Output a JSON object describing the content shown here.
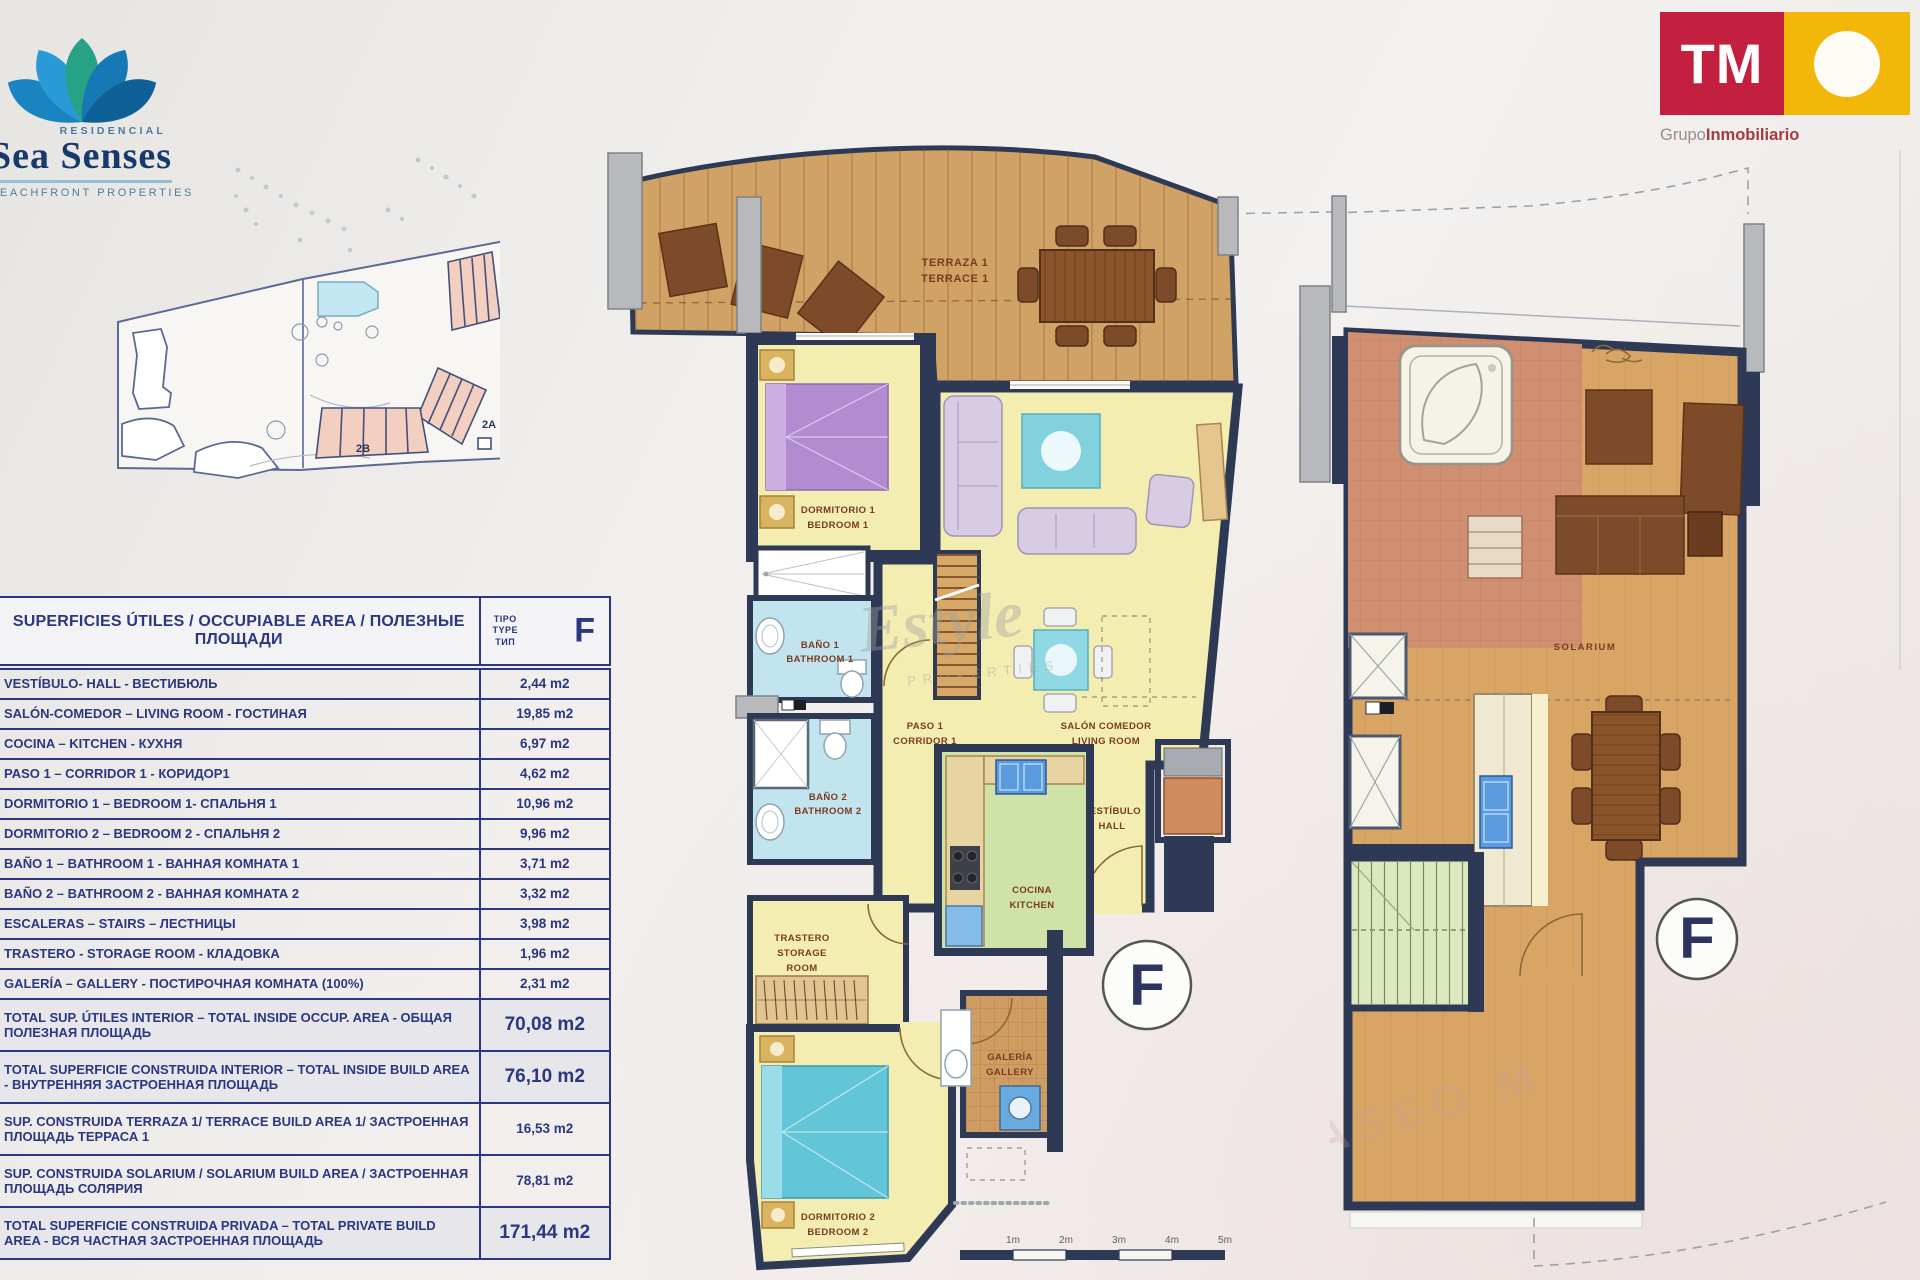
{
  "branding": {
    "residencial": "RESIDENCIAL",
    "name": "Sea Senses",
    "tagline": "BEACHFRONT PROPERTIES",
    "tm": "TM",
    "grupo": "Grupo",
    "inmobiliario": "Inmobiliario",
    "colors": {
      "crimson": "#c2203e",
      "yellow": "#f3b70a",
      "navy": "#17396b",
      "teal": "#27a287",
      "blue": "#1d7ab5"
    }
  },
  "site_plan": {
    "building_labels": [
      "1",
      "2A",
      "2B"
    ]
  },
  "table": {
    "title": "SUPERFICIES ÚTILES / OCCUPIABLE AREA / ПОЛЕЗНЫЕ ПЛОЩАДИ",
    "type_label": [
      "TIPO",
      "TYPE",
      "ТИП"
    ],
    "type_value": "F",
    "rows": [
      {
        "label": "VESTÍBULO- HALL - ВЕСТИБЮЛЬ",
        "value": "2,44 m2"
      },
      {
        "label": "SALÓN-COMEDOR – LIVING ROOM - ГОСТИНАЯ",
        "value": "19,85 m2"
      },
      {
        "label": "COCINA – KITCHEN - КУХНЯ",
        "value": "6,97 m2"
      },
      {
        "label": "PASO 1 – CORRIDOR 1 - КОРИДОР1",
        "value": "4,62 m2"
      },
      {
        "label": "DORMITORIO 1 – BEDROOM 1- СПАЛЬНЯ 1",
        "value": "10,96 m2"
      },
      {
        "label": "DORMITORIO 2 – BEDROOM 2 - СПАЛЬНЯ 2",
        "value": "9,96 m2"
      },
      {
        "label": "BAÑO 1 – BATHROOM 1 - ВАННАЯ КОМНАТА 1",
        "value": "3,71 m2"
      },
      {
        "label": "BAÑO 2 – BATHROOM 2 - ВАННАЯ КОМНАТА 2",
        "value": "3,32 m2"
      },
      {
        "label": "ESCALERAS – STAIRS – ЛЕСТНИЦЫ",
        "value": "3,98 m2"
      },
      {
        "label": "TRASTERO - STORAGE ROOM - КЛАДОВКА",
        "value": "1,96 m2"
      },
      {
        "label": "GALERÍA – GALLERY - ПОСТИРОЧНАЯ КОМНАТА (100%)",
        "value": "2,31 m2"
      },
      {
        "label": "TOTAL SUP. ÚTILES INTERIOR –  TOTAL INSIDE OCCUP. AREA - ОБЩАЯ ПОЛЕЗНАЯ ПЛОЩАДЬ",
        "value": "70,08 m2",
        "strong": true
      },
      {
        "label": "TOTAL SUPERFICIE CONSTRUIDA INTERIOR –  TOTAL INSIDE BUILD AREA - ВНУТРЕННЯЯ ЗАСТРОЕННАЯ ПЛОЩАДЬ",
        "value": "76,10 m2",
        "strong": true
      },
      {
        "label": "SUP. CONSTRUIDA TERRAZA 1/ TERRACE BUILD AREA 1/ ЗАСТРОЕННАЯ ПЛОЩАДЬ ТЕРРАСА 1",
        "value": "16,53 m2"
      },
      {
        "label": "SUP. CONSTRUIDA SOLARIUM / SOLARIUM BUILD AREA / ЗАСТРОЕННАЯ ПЛОЩАДЬ СОЛЯРИЯ",
        "value": "78,81 m2"
      },
      {
        "label": "TOTAL SUPERFICIE CONSTRUIDA PRIVADA – TOTAL PRIVATE BUILD AREA - ВСЯ ЧАСТНАЯ ЗАСТРОЕННАЯ ПЛОЩАДЬ",
        "value": "171,44 m2",
        "strong": true
      }
    ]
  },
  "plan_main": {
    "unit_letter": "F",
    "labels": {
      "terraza": [
        "TERRAZA 1",
        "TERRACE 1"
      ],
      "dormitorio1": [
        "DORMITORIO 1",
        "BEDROOM 1"
      ],
      "bano1": [
        "BAÑO 1",
        "BATHROOM 1"
      ],
      "bano2": [
        "BAÑO 2",
        "BATHROOM 2"
      ],
      "paso": [
        "PASO 1",
        "CORRIDOR 1"
      ],
      "salon": [
        "SALÓN COMEDOR",
        "LIVING ROOM"
      ],
      "vestibulo": [
        "VESTÍBULO",
        "HALL"
      ],
      "cocina": [
        "COCINA",
        "KITCHEN"
      ],
      "trastero": [
        "TRASTERO",
        "STORAGE",
        "ROOM"
      ],
      "galeria": [
        "GALERÍA",
        "GALLERY"
      ],
      "dormitorio2": [
        "DORMITORIO 2",
        "BEDROOM 2"
      ]
    }
  },
  "plan_solarium": {
    "label": "SOLARIUM",
    "unit_letter": "F"
  },
  "scale_bar": {
    "labels": [
      "1m",
      "2m",
      "3m",
      "4m",
      "5m"
    ]
  },
  "watermarks": {
    "script": "Estyle",
    "script_sub": "PROPERTIES",
    "street": "PASEO M"
  }
}
